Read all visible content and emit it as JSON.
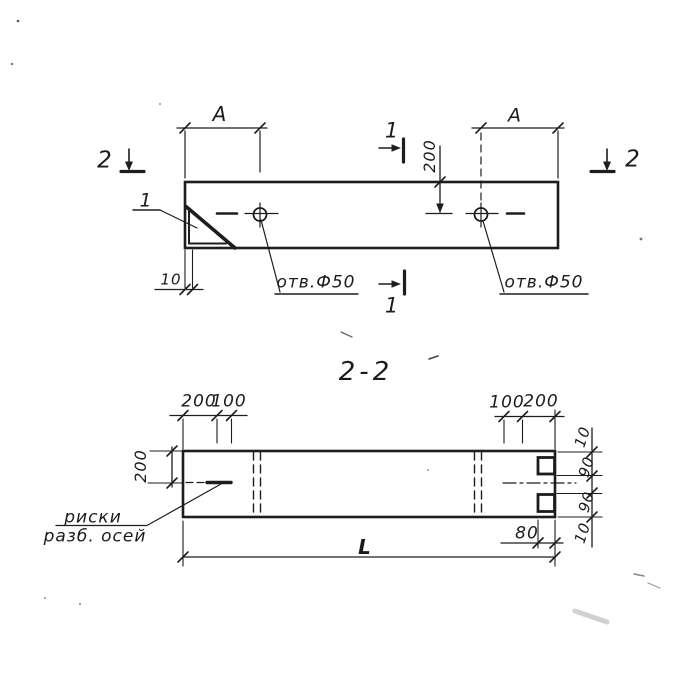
{
  "drawing": {
    "ink_color": "#1d1d1d",
    "paper_color": "#ffffff",
    "top_view": {
      "dim_a_left": "A",
      "dim_a_right": "A",
      "dim_200": "200",
      "dim_10": "10",
      "hole_label_left": "отв.Ф50",
      "hole_label_right": "отв.Ф50",
      "part_mark": "1",
      "section_mark_1_top": "1",
      "section_mark_1_bottom": "1",
      "section_mark_2_left": "2",
      "section_mark_2_right": "2"
    },
    "section_view": {
      "title": "2-2",
      "dim_top_left_200": "200",
      "dim_top_left_100": "100",
      "dim_top_right_100": "100",
      "dim_top_right_200": "200",
      "dim_left_200": "200",
      "dim_right_10_top": "10",
      "dim_right_90_top": "90",
      "dim_right_90_bottom": "90",
      "dim_right_10_bottom": "10",
      "dim_80": "80",
      "dim_length": "L",
      "axis_note_line1": "риски",
      "axis_note_line2": "разб. осей"
    }
  }
}
